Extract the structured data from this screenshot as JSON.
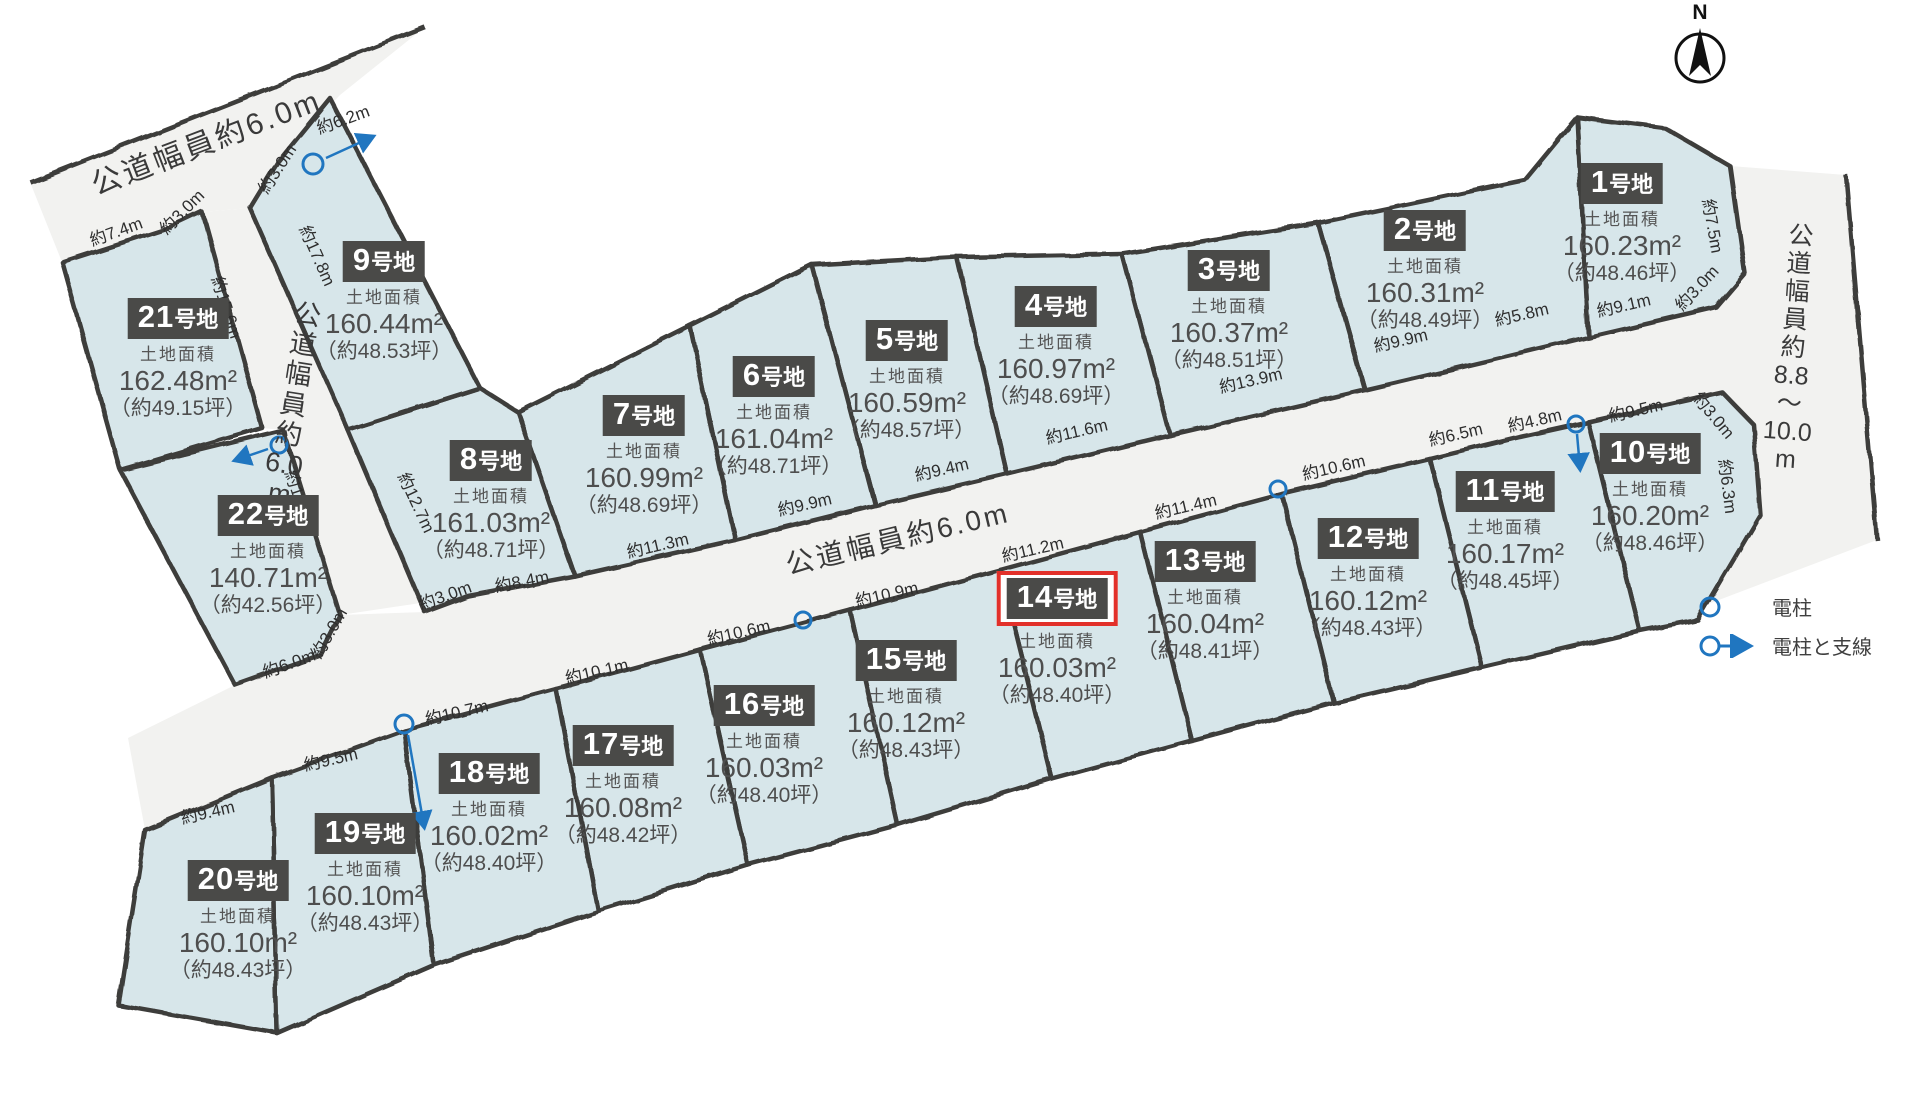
{
  "north_label": "N",
  "area_caption": "土地面積",
  "plot_suffix": "号地",
  "colors": {
    "plot_fill": "#d7e6ea",
    "road_fill": "#f2f2f0",
    "line": "#3d3d3b",
    "badge": "#4a4a48",
    "highlight": "#e2302a",
    "pole": "#2076c0"
  },
  "roads": {
    "top_left": "公道幅員約6.0m",
    "central": "公道幅員約6.0m",
    "vertical_chars": [
      "公",
      "道",
      "幅",
      "員",
      "約",
      "6.0",
      "m"
    ],
    "right_chars": [
      "公",
      "道",
      "幅",
      "員",
      "約",
      "8.8",
      "〜",
      "10.0",
      "m"
    ]
  },
  "legend": {
    "pole": "電柱",
    "pole_wire": "電柱と支線"
  },
  "plots": [
    {
      "id": "1",
      "num": "1",
      "area": "160.23m²",
      "tsubo": "（約48.46坪）",
      "cx": 1622,
      "top": 163,
      "highlighted": false
    },
    {
      "id": "2",
      "num": "2",
      "area": "160.31m²",
      "tsubo": "（約48.49坪）",
      "cx": 1425,
      "top": 210,
      "highlighted": false
    },
    {
      "id": "3",
      "num": "3",
      "area": "160.37m²",
      "tsubo": "（約48.51坪）",
      "cx": 1229,
      "top": 250,
      "highlighted": false
    },
    {
      "id": "4",
      "num": "4",
      "area": "160.97m²",
      "tsubo": "（約48.69坪）",
      "cx": 1056,
      "top": 286,
      "highlighted": false
    },
    {
      "id": "5",
      "num": "5",
      "area": "160.59m²",
      "tsubo": "（約48.57坪）",
      "cx": 907,
      "top": 320,
      "highlighted": false
    },
    {
      "id": "6",
      "num": "6",
      "area": "161.04m²",
      "tsubo": "（約48.71坪）",
      "cx": 774,
      "top": 356,
      "highlighted": false
    },
    {
      "id": "7",
      "num": "7",
      "area": "160.99m²",
      "tsubo": "（約48.69坪）",
      "cx": 644,
      "top": 395,
      "highlighted": false
    },
    {
      "id": "8",
      "num": "8",
      "area": "161.03m²",
      "tsubo": "（約48.71坪）",
      "cx": 491,
      "top": 440,
      "highlighted": false
    },
    {
      "id": "9",
      "num": "9",
      "area": "160.44m²",
      "tsubo": "（約48.53坪）",
      "cx": 384,
      "top": 241,
      "highlighted": false
    },
    {
      "id": "10",
      "num": "10",
      "area": "160.20m²",
      "tsubo": "（約48.46坪）",
      "cx": 1650,
      "top": 433,
      "highlighted": false
    },
    {
      "id": "11",
      "num": "11",
      "area": "160.17m²",
      "tsubo": "（約48.45坪）",
      "cx": 1505,
      "top": 471,
      "highlighted": false
    },
    {
      "id": "12",
      "num": "12",
      "area": "160.12m²",
      "tsubo": "（約48.43坪）",
      "cx": 1368,
      "top": 518,
      "highlighted": false
    },
    {
      "id": "13",
      "num": "13",
      "area": "160.04m²",
      "tsubo": "（約48.41坪）",
      "cx": 1205,
      "top": 541,
      "highlighted": false
    },
    {
      "id": "14",
      "num": "14",
      "area": "160.03m²",
      "tsubo": "（約48.40坪）",
      "cx": 1057,
      "top": 571,
      "highlighted": true
    },
    {
      "id": "15",
      "num": "15",
      "area": "160.12m²",
      "tsubo": "（約48.43坪）",
      "cx": 906,
      "top": 640,
      "highlighted": false
    },
    {
      "id": "16",
      "num": "16",
      "area": "160.03m²",
      "tsubo": "（約48.40坪）",
      "cx": 764,
      "top": 685,
      "highlighted": false
    },
    {
      "id": "17",
      "num": "17",
      "area": "160.08m²",
      "tsubo": "（約48.42坪）",
      "cx": 623,
      "top": 725,
      "highlighted": false
    },
    {
      "id": "18",
      "num": "18",
      "area": "160.02m²",
      "tsubo": "（約48.40坪）",
      "cx": 489,
      "top": 753,
      "highlighted": false
    },
    {
      "id": "19",
      "num": "19",
      "area": "160.10m²",
      "tsubo": "（約48.43坪）",
      "cx": 365,
      "top": 813,
      "highlighted": false
    },
    {
      "id": "20",
      "num": "20",
      "area": "160.10m²",
      "tsubo": "（約48.43坪）",
      "cx": 238,
      "top": 860,
      "highlighted": false
    },
    {
      "id": "21",
      "num": "21",
      "area": "162.48m²",
      "tsubo": "（約49.15坪）",
      "cx": 178,
      "top": 298,
      "highlighted": false
    },
    {
      "id": "22",
      "num": "22",
      "area": "140.71m²",
      "tsubo": "（約42.56坪）",
      "cx": 268,
      "top": 495,
      "highlighted": false
    }
  ],
  "dimensions": [
    {
      "t": "約7.4m",
      "x": 118,
      "y": 237,
      "r": -20
    },
    {
      "t": "約3.0m",
      "x": 186,
      "y": 216,
      "r": -45
    },
    {
      "t": "約15.6m",
      "x": 221,
      "y": 309,
      "r": 72
    },
    {
      "t": "約3.0m",
      "x": 282,
      "y": 172,
      "r": -57
    },
    {
      "t": "約6.2m",
      "x": 345,
      "y": 125,
      "r": -20
    },
    {
      "t": "約17.8m",
      "x": 312,
      "y": 258,
      "r": 66
    },
    {
      "t": "約14.7m",
      "x": 295,
      "y": 503,
      "r": 71
    },
    {
      "t": "約12.7m",
      "x": 411,
      "y": 505,
      "r": 65
    },
    {
      "t": "約3.0m",
      "x": 334,
      "y": 636,
      "r": -60
    },
    {
      "t": "約6.0m",
      "x": 291,
      "y": 669,
      "r": -20
    },
    {
      "t": "約3.0m",
      "x": 447,
      "y": 601,
      "r": -20
    },
    {
      "t": "約8.4m",
      "x": 523,
      "y": 587,
      "r": -11
    },
    {
      "t": "約11.3m",
      "x": 659,
      "y": 551,
      "r": -13
    },
    {
      "t": "約9.9m",
      "x": 806,
      "y": 510,
      "r": -13
    },
    {
      "t": "約9.4m",
      "x": 943,
      "y": 475,
      "r": -13
    },
    {
      "t": "約11.6m",
      "x": 1078,
      "y": 437,
      "r": -13
    },
    {
      "t": "約13.9m",
      "x": 1252,
      "y": 386,
      "r": -13
    },
    {
      "t": "約9.9m",
      "x": 1402,
      "y": 346,
      "r": -13
    },
    {
      "t": "約5.8m",
      "x": 1523,
      "y": 320,
      "r": -13
    },
    {
      "t": "約9.1m",
      "x": 1625,
      "y": 311,
      "r": -13
    },
    {
      "t": "約3.0m",
      "x": 1701,
      "y": 292,
      "r": -47
    },
    {
      "t": "約7.5m",
      "x": 1707,
      "y": 227,
      "r": 80
    },
    {
      "t": "約9.5m",
      "x": 1637,
      "y": 416,
      "r": -13
    },
    {
      "t": "約3.0m",
      "x": 1709,
      "y": 419,
      "r": 50
    },
    {
      "t": "約6.3m",
      "x": 1722,
      "y": 487,
      "r": 83
    },
    {
      "t": "約4.8m",
      "x": 1536,
      "y": 426,
      "r": -13
    },
    {
      "t": "約6.5m",
      "x": 1457,
      "y": 440,
      "r": -13
    },
    {
      "t": "約10.6m",
      "x": 1335,
      "y": 473,
      "r": -13
    },
    {
      "t": "約11.4m",
      "x": 1187,
      "y": 512,
      "r": -13
    },
    {
      "t": "約11.2m",
      "x": 1034,
      "y": 555,
      "r": -13
    },
    {
      "t": "約10.9m",
      "x": 888,
      "y": 600,
      "r": -13
    },
    {
      "t": "約10.6m",
      "x": 740,
      "y": 638,
      "r": -13
    },
    {
      "t": "約10.1m",
      "x": 598,
      "y": 677,
      "r": -13
    },
    {
      "t": "約10.7m",
      "x": 458,
      "y": 718,
      "r": -13
    },
    {
      "t": "約9.5m",
      "x": 332,
      "y": 765,
      "r": -13
    },
    {
      "t": "約9.4m",
      "x": 209,
      "y": 818,
      "r": -13
    }
  ]
}
